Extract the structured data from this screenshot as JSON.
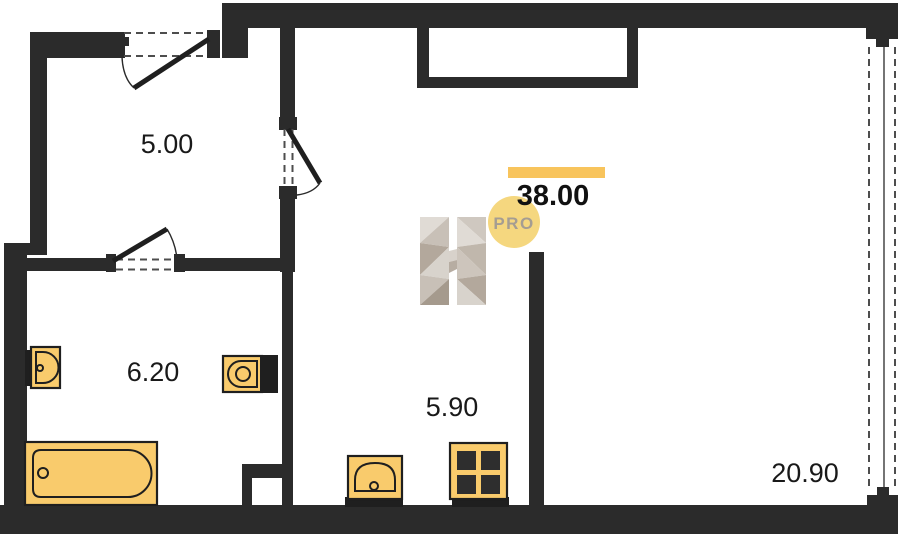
{
  "plan": {
    "labels": {
      "hallway_area": "5.00",
      "bathroom_area": "6.20",
      "kitchen_area": "5.90",
      "living_room_area": "20.90",
      "total_area": "38.00"
    },
    "watermark": {
      "letter": "H",
      "badge": "PRO"
    },
    "colors": {
      "wall": "#2b2b2b",
      "fixture_fill": "#f9cb6c",
      "fixture_stroke": "#1f1f1f",
      "accent_bar": "#f8c45c",
      "badge_fill": "#f5d77f",
      "badge_text": "#a59d92",
      "burner": "#2e2e2e",
      "dashed_line": "#4d4d4d"
    }
  }
}
